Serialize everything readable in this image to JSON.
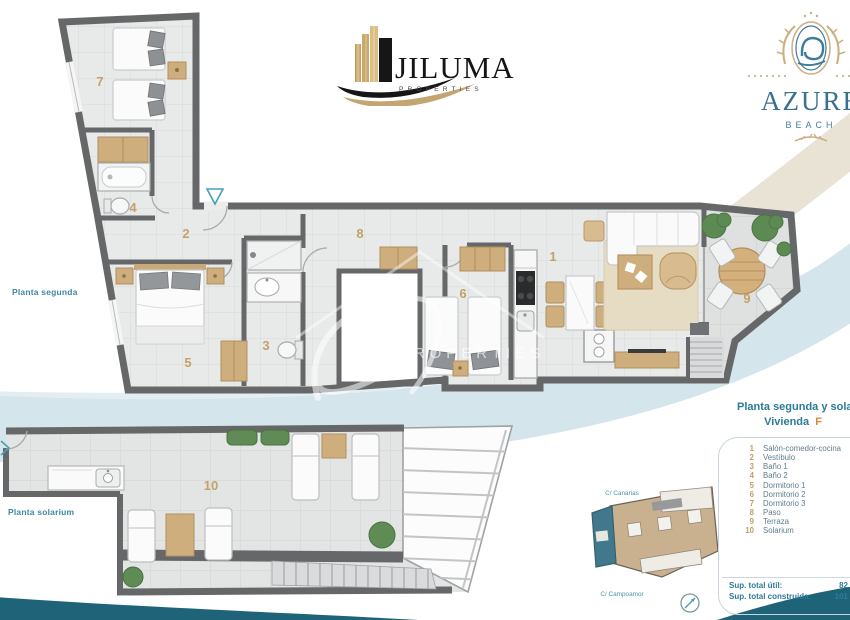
{
  "brand": {
    "jiluma": {
      "name": "JILUMA",
      "tagline": "PROPERTIES"
    },
    "azure": {
      "name": "AZURE",
      "tagline": "BEACH"
    }
  },
  "labels": {
    "planta_segunda": "Planta segunda",
    "planta_solarium": "Planta solarium"
  },
  "rooms": [
    "1",
    "2",
    "3",
    "4",
    "5",
    "6",
    "7",
    "8",
    "9",
    "10"
  ],
  "panel": {
    "title": "Planta segunda y solarium",
    "vivienda_label": "Vivienda",
    "vivienda_value": "F",
    "legend": [
      {
        "num": "1",
        "label": "Salón-comedor-cocina"
      },
      {
        "num": "2",
        "label": "Vestíbulo"
      },
      {
        "num": "3",
        "label": "Baño 1"
      },
      {
        "num": "4",
        "label": "Baño 2"
      },
      {
        "num": "5",
        "label": "Dormitorio 1"
      },
      {
        "num": "6",
        "label": "Dormitorio 2"
      },
      {
        "num": "7",
        "label": "Dormitorio 3"
      },
      {
        "num": "8",
        "label": "Paso"
      },
      {
        "num": "9",
        "label": "Terraza"
      },
      {
        "num": "10",
        "label": "Solarium"
      }
    ],
    "totals": [
      {
        "label": "Sup. total útil:",
        "value": "82"
      },
      {
        "label": "Sup. total construida:",
        "value": "101"
      }
    ]
  },
  "site": {
    "street_top": "C/ Canarias",
    "street_bottom": "C/ Campoamor"
  },
  "watermark": {
    "text": "PROPERTIES"
  },
  "colors": {
    "accent_teal": "#2d7b97",
    "accent_gold": "#bf9e63",
    "wave_dark": "#1e6377",
    "wall": "#656769"
  }
}
